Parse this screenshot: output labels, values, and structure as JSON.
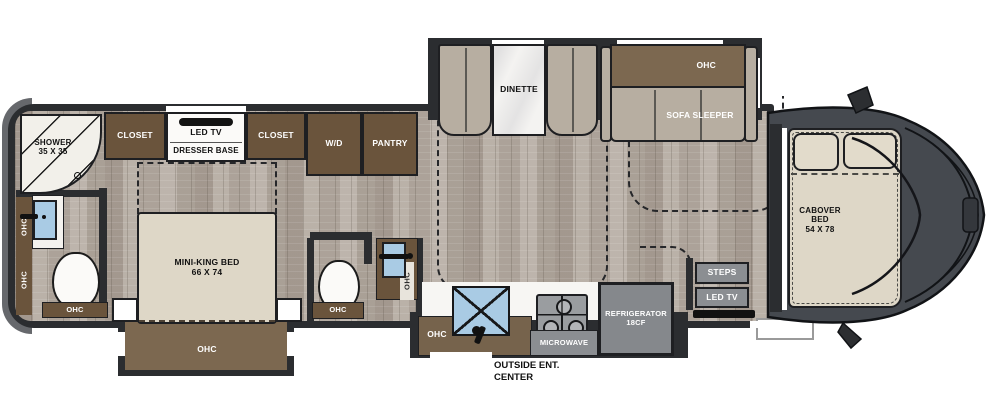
{
  "colors": {
    "wall": "#2b2d30",
    "cabinet_brown": "#6a543c",
    "overhead_brown": "#7c6850",
    "floor_wood": "#b3aaa1",
    "cushion_gray": "#b7aea1",
    "bed_beige": "#ded7c7",
    "cab_gray": "#45494f",
    "fixture_gray": "#8b8e92",
    "sink_blue": "#a9cbe4",
    "table_white": "#f4f3f1"
  },
  "rear_bath": {
    "shower_label": "SHOWER",
    "shower_size": "35 X 35",
    "sink_ohc": "OHC",
    "cabinet_ohc": "OHC",
    "toilet_ohc": "OHC"
  },
  "bedroom": {
    "closet_left": "CLOSET",
    "tv": "LED TV",
    "dresser": "DRESSER BASE",
    "closet_right": "CLOSET",
    "bed_label": "MINI-KING BED",
    "bed_size": "66 X 74",
    "foot_ohc": "OHC"
  },
  "laundry": {
    "washer_dryer": "W/D",
    "pantry": "PANTRY"
  },
  "mid_bath": {
    "toilet_ohc": "OHC",
    "sink_ohc": "OHC"
  },
  "living": {
    "dinette": "DINETTE",
    "sofa_ohc": "OHC",
    "sofa": "SOFA SLEEPER"
  },
  "kitchen": {
    "sink_ohc": "OHC",
    "microwave": "MICROWAVE",
    "refrigerator_line1": "REFRIGERATOR",
    "refrigerator_line2": "18CF",
    "outside_line1": "OUTSIDE ENT.",
    "outside_line2": "CENTER"
  },
  "entry": {
    "steps": "STEPS",
    "tv": "LED TV"
  },
  "cab": {
    "bed_line1": "CABOVER",
    "bed_line2": "BED",
    "bed_size": "54 X 78"
  }
}
